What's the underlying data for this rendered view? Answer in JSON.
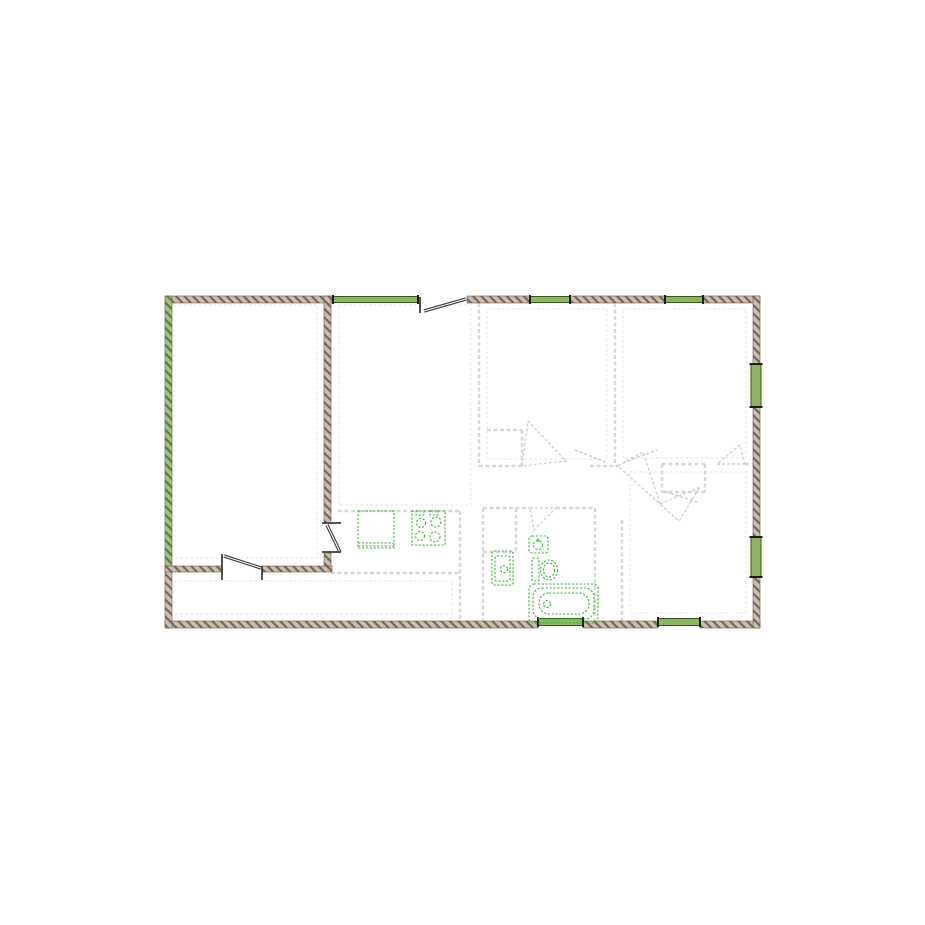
{
  "title": "apartment-floor-plan",
  "canvas": {
    "width": 925,
    "height": 925,
    "background": "#ffffff"
  },
  "palette": {
    "wall_fill": "#cbbfb0",
    "wall_hatch": "#77675a",
    "wall_outline": "#6b5b4e",
    "green_wall_fill": "#a3c183",
    "green_wall_hatch": "#55803a",
    "window_fill": "#8bb562",
    "window_border": "#37561f",
    "window_cap": "#1d1d1d",
    "partition": "#d8d8d8",
    "inset": "#e8e8e8",
    "swing": "#d2d2d2",
    "fixture": "#3bb53b",
    "door": "#3d3d3d"
  },
  "plan": {
    "wall_segments": [
      {
        "x": 165,
        "y": 296,
        "w": 168,
        "h": 7,
        "material": "brown"
      },
      {
        "x": 467,
        "y": 296,
        "w": 63,
        "h": 7,
        "material": "brown"
      },
      {
        "x": 570,
        "y": 296,
        "w": 95,
        "h": 7,
        "material": "brown"
      },
      {
        "x": 703,
        "y": 296,
        "w": 57,
        "h": 7,
        "material": "brown"
      },
      {
        "x": 165,
        "y": 621,
        "w": 373,
        "h": 7,
        "material": "brown"
      },
      {
        "x": 583,
        "y": 621,
        "w": 75,
        "h": 7,
        "material": "brown"
      },
      {
        "x": 700,
        "y": 621,
        "w": 60,
        "h": 7,
        "material": "brown"
      },
      {
        "x": 165,
        "y": 296,
        "w": 7,
        "h": 272,
        "material": "green"
      },
      {
        "x": 165,
        "y": 568,
        "w": 7,
        "h": 60,
        "material": "brown"
      },
      {
        "x": 753,
        "y": 296,
        "w": 7,
        "h": 68,
        "material": "brown"
      },
      {
        "x": 753,
        "y": 407,
        "w": 7,
        "h": 130,
        "material": "brown"
      },
      {
        "x": 753,
        "y": 577,
        "w": 7,
        "h": 51,
        "material": "brown"
      },
      {
        "x": 324,
        "y": 296,
        "w": 7,
        "h": 227,
        "material": "brown"
      },
      {
        "x": 324,
        "y": 553,
        "w": 7,
        "h": 14,
        "material": "brown"
      },
      {
        "x": 165,
        "y": 566,
        "w": 57,
        "h": 6,
        "material": "brown"
      },
      {
        "x": 262,
        "y": 566,
        "w": 70,
        "h": 6,
        "material": "brown"
      }
    ],
    "windows": [
      {
        "x": 333,
        "y": 296.5,
        "w": 85,
        "h": 6,
        "dir": "h"
      },
      {
        "x": 530,
        "y": 296.5,
        "w": 40,
        "h": 6,
        "dir": "h"
      },
      {
        "x": 665,
        "y": 296.5,
        "w": 38,
        "h": 6,
        "dir": "h"
      },
      {
        "x": 538,
        "y": 618.5,
        "w": 45,
        "h": 7,
        "dir": "h"
      },
      {
        "x": 658,
        "y": 618.5,
        "w": 42,
        "h": 7,
        "dir": "h"
      },
      {
        "x": 751,
        "y": 364,
        "w": 10,
        "h": 43,
        "dir": "v"
      },
      {
        "x": 751,
        "y": 537,
        "w": 10,
        "h": 40,
        "dir": "v"
      }
    ],
    "door_ticks": [
      {
        "x1": 322,
        "y1": 523,
        "x2": 341,
        "y2": 523
      },
      {
        "x1": 322,
        "y1": 552,
        "x2": 341,
        "y2": 552
      },
      {
        "x1": 420,
        "y1": 297,
        "x2": 420,
        "y2": 313
      },
      {
        "x1": 222,
        "y1": 566,
        "x2": 222,
        "y2": 580
      },
      {
        "x1": 262,
        "y1": 566,
        "x2": 262,
        "y2": 580
      },
      {
        "x1": 222,
        "y1": 554,
        "x2": 222,
        "y2": 566
      }
    ],
    "door_leaves": [
      {
        "x1": 424,
        "y1": 311,
        "x2": 466,
        "y2": 299
      },
      {
        "x1": 327,
        "y1": 525,
        "x2": 340,
        "y2": 552
      },
      {
        "x1": 224,
        "y1": 556,
        "x2": 261,
        "y2": 568
      }
    ],
    "partitions": [
      {
        "x1": 479,
        "y1": 303,
        "x2": 479,
        "y2": 466
      },
      {
        "x1": 615,
        "y1": 303,
        "x2": 615,
        "y2": 466
      },
      {
        "x1": 479,
        "y1": 466,
        "x2": 522,
        "y2": 466
      },
      {
        "x1": 590,
        "y1": 466,
        "x2": 618,
        "y2": 466
      },
      {
        "x1": 662,
        "y1": 464,
        "x2": 705,
        "y2": 464
      },
      {
        "x1": 745,
        "y1": 464,
        "x2": 753,
        "y2": 464
      },
      {
        "x1": 487,
        "y1": 430,
        "x2": 522,
        "y2": 430
      },
      {
        "x1": 522,
        "y1": 430,
        "x2": 522,
        "y2": 466
      },
      {
        "x1": 662,
        "y1": 464,
        "x2": 662,
        "y2": 492
      },
      {
        "x1": 705,
        "y1": 464,
        "x2": 705,
        "y2": 492
      },
      {
        "x1": 662,
        "y1": 492,
        "x2": 705,
        "y2": 492
      },
      {
        "x1": 483,
        "y1": 508,
        "x2": 483,
        "y2": 621
      },
      {
        "x1": 595,
        "y1": 508,
        "x2": 595,
        "y2": 621
      },
      {
        "x1": 483,
        "y1": 508,
        "x2": 530,
        "y2": 508
      },
      {
        "x1": 556,
        "y1": 508,
        "x2": 595,
        "y2": 508
      },
      {
        "x1": 516,
        "y1": 508,
        "x2": 516,
        "y2": 552
      },
      {
        "x1": 483,
        "y1": 552,
        "x2": 516,
        "y2": 552
      },
      {
        "x1": 622,
        "y1": 520,
        "x2": 622,
        "y2": 621
      },
      {
        "x1": 460,
        "y1": 511,
        "x2": 460,
        "y2": 621
      },
      {
        "x1": 338,
        "y1": 511,
        "x2": 460,
        "y2": 511
      },
      {
        "x1": 331,
        "y1": 573,
        "x2": 460,
        "y2": 573
      }
    ],
    "swing_triangles": [
      {
        "points": [
          [
            522,
            466
          ],
          [
            528,
            421
          ],
          [
            566,
            461
          ]
        ]
      },
      {
        "points": [
          [
            618,
            466
          ],
          [
            643,
            452
          ],
          [
            660,
            504
          ]
        ]
      },
      {
        "points": [
          [
            660,
            504
          ],
          [
            700,
            487
          ],
          [
            679,
            521
          ]
        ]
      },
      {
        "points": [
          [
            745,
            464
          ],
          [
            717,
            464
          ],
          [
            740,
            445
          ]
        ]
      },
      {
        "points": [
          [
            530,
            508
          ],
          [
            556,
            508
          ],
          [
            534,
            530
          ]
        ]
      }
    ],
    "swing_leaves": [
      {
        "x1": 575,
        "y1": 450,
        "x2": 608,
        "y2": 463
      },
      {
        "x1": 623,
        "y1": 463,
        "x2": 657,
        "y2": 450
      },
      {
        "x1": 666,
        "y1": 492,
        "x2": 697,
        "y2": 502
      }
    ],
    "room_insets": [
      {
        "x": 174,
        "y": 305,
        "w": 143,
        "h": 253
      },
      {
        "x": 339,
        "y": 305,
        "w": 132,
        "h": 200
      },
      {
        "x": 487,
        "y": 309,
        "w": 120,
        "h": 150
      },
      {
        "x": 623,
        "y": 309,
        "w": 123,
        "h": 149
      },
      {
        "x": 630,
        "y": 472,
        "w": 116,
        "h": 141
      },
      {
        "x": 174,
        "y": 581,
        "w": 278,
        "h": 33
      }
    ],
    "fixtures": [
      {
        "name": "kitchen-counter",
        "shapes": [
          {
            "t": "rect",
            "x": 358,
            "y": 511,
            "w": 36,
            "h": 37
          },
          {
            "t": "line",
            "x1": 358,
            "y1": 543,
            "x2": 394,
            "y2": 543
          },
          {
            "t": "line",
            "x1": 358,
            "y1": 546,
            "x2": 394,
            "y2": 546
          }
        ]
      },
      {
        "name": "kitchen-stove",
        "shapes": [
          {
            "t": "rect",
            "x": 412,
            "y": 511,
            "w": 33,
            "h": 34
          },
          {
            "t": "circle",
            "cx": 421,
            "cy": 523,
            "r": 4.5
          },
          {
            "t": "circle",
            "cx": 436,
            "cy": 522,
            "r": 5
          },
          {
            "t": "circle",
            "cx": 420,
            "cy": 536,
            "r": 4.5
          },
          {
            "t": "circle",
            "cx": 435,
            "cy": 537,
            "r": 5
          },
          {
            "t": "rect",
            "x": 416,
            "y": 511,
            "w": 8,
            "h": 4
          },
          {
            "t": "rect",
            "x": 430,
            "y": 511,
            "w": 8,
            "h": 4
          }
        ]
      },
      {
        "name": "bathroom-basin",
        "shapes": [
          {
            "t": "rect",
            "x": 492,
            "y": 551,
            "w": 21,
            "h": 34,
            "r": 2
          },
          {
            "t": "rect",
            "x": 495,
            "y": 556,
            "w": 15,
            "h": 25,
            "r": 2
          },
          {
            "t": "circle",
            "cx": 504,
            "cy": 569,
            "r": 3.5
          }
        ]
      },
      {
        "name": "corner-sink",
        "shapes": [
          {
            "t": "rect",
            "x": 529,
            "y": 536,
            "w": 19,
            "h": 17,
            "r": 3
          },
          {
            "t": "circle",
            "cx": 538,
            "cy": 545,
            "r": 4.5
          },
          {
            "t": "circle",
            "cx": 538,
            "cy": 540,
            "r": 1.2
          }
        ]
      },
      {
        "name": "toilet",
        "shapes": [
          {
            "t": "rect",
            "x": 532,
            "y": 558,
            "w": 7,
            "h": 23,
            "r": 1
          },
          {
            "t": "ellipse",
            "cx": 549,
            "cy": 570,
            "rx": 8.5,
            "ry": 10
          },
          {
            "t": "ellipse",
            "cx": 549,
            "cy": 570,
            "rx": 5.5,
            "ry": 7
          }
        ]
      },
      {
        "name": "bathtub",
        "shapes": [
          {
            "t": "rect",
            "x": 529,
            "y": 584,
            "w": 69,
            "h": 39,
            "r": 5
          },
          {
            "t": "rect",
            "x": 533,
            "y": 588,
            "w": 61,
            "h": 31,
            "r": 9
          },
          {
            "t": "rect",
            "x": 539,
            "y": 593,
            "w": 50,
            "h": 21,
            "r": 10
          },
          {
            "t": "circle",
            "cx": 547,
            "cy": 604,
            "r": 3.5
          }
        ]
      }
    ]
  }
}
